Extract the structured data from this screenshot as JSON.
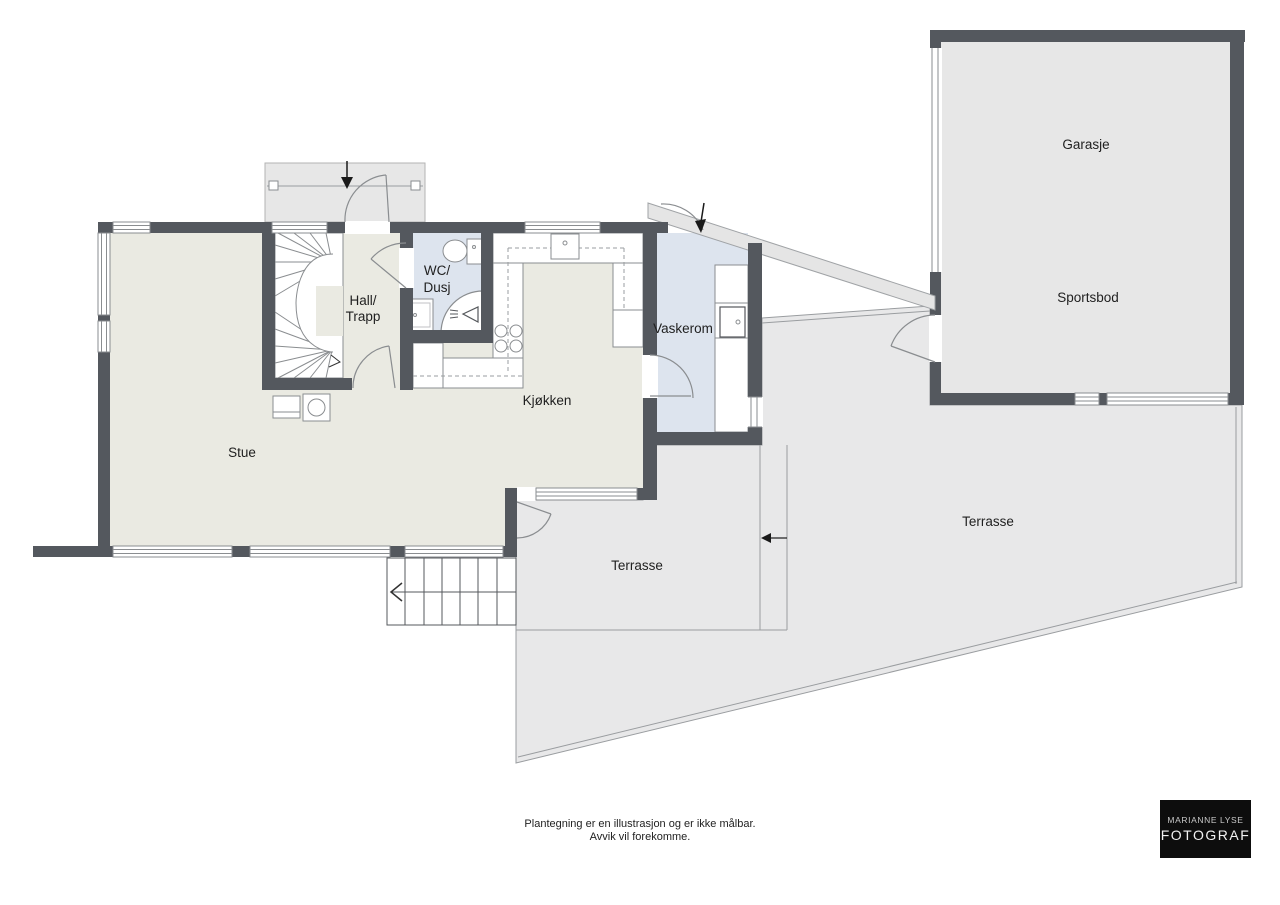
{
  "plan": {
    "rooms": {
      "stue": "Stue",
      "hall_trapp": {
        "line1": "Hall/",
        "line2": "Trapp"
      },
      "wc_dusj": {
        "line1": "WC/",
        "line2": "Dusj"
      },
      "kjokken": "Kjøkken",
      "vaskerom": "Vaskerom",
      "garasje": "Garasje",
      "sportsbod": "Sportsbod",
      "terrasse_small": "Terrasse",
      "terrasse_large": "Terrasse"
    },
    "disclaimer": {
      "line1": "Plantegning er en illustrasjon og er ikke målbar.",
      "line2": "Avvik vil forekomme."
    },
    "logo": {
      "line1": "MARIANNE LYSE",
      "line2": "FOTOGRAF"
    },
    "colors": {
      "wall": "#54585e",
      "interior_floor": "#eaeae2",
      "wet_room_floor": "#dde4ee",
      "terrace": "#e8e8e9",
      "outdoor_structure": "#e7e7e7",
      "line": "#8a8d90",
      "text": "#1f1f1f",
      "logo_background": "#0d0d0d",
      "logo_text": "#f2f2f2"
    },
    "icons": {
      "main_entrance_arrow": "down-arrow",
      "side_entrance_arrow": "down-arrow",
      "terrace_step_arrow": "left-arrow",
      "outdoor_stair_arrow": "left-arrow",
      "stair_direction_arrow": "right-arrow"
    }
  }
}
